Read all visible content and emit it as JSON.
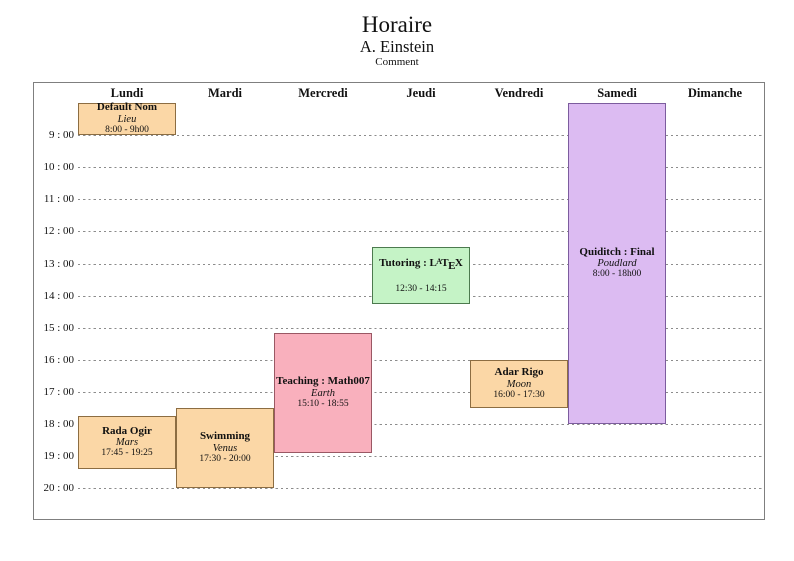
{
  "header": {
    "title": "Horaire",
    "subtitle": "A. Einstein",
    "comment": "Comment"
  },
  "colors": {
    "frame_border": "#7f7f7f",
    "grid_line": "#8c8c8c",
    "text": "#111111",
    "orange_fill": "#FBD7A6",
    "orange_border": "#8C6D42",
    "green_fill": "#C5F3C6",
    "green_border": "#4C7A4E",
    "pink_fill": "#F9B0BD",
    "pink_border": "#9A5864",
    "purple_fill": "#DCBBF2",
    "purple_border": "#7C5C9E"
  },
  "chart_data": {
    "type": "table",
    "title": "Horaire",
    "subtitle": "A. Einstein",
    "comment": "Comment",
    "days": [
      "Lundi",
      "Mardi",
      "Mercredi",
      "Jeudi",
      "Vendredi",
      "Samedi",
      "Dimanche"
    ],
    "hour_labels": [
      "9 : 00",
      "10 : 00",
      "11 : 00",
      "12 : 00",
      "13 : 00",
      "14 : 00",
      "15 : 00",
      "16 : 00",
      "17 : 00",
      "18 : 00",
      "19 : 00",
      "20 : 00"
    ],
    "time_axis": {
      "first_labeled_hour": 9,
      "last_labeled_hour": 20,
      "grid": "dashed-horizontal"
    },
    "events": [
      {
        "day": "Lundi",
        "title": "Default Nom",
        "location": "Lieu",
        "time_label": "8:00 - 9h00",
        "start": 8.0,
        "end": 9.0,
        "fill": "#FBD7A6",
        "border": "#8C6D42"
      },
      {
        "day": "Lundi",
        "title": "Rada Ogir",
        "location": "Mars",
        "time_label": "17:45 - 19:25",
        "start": 17.75,
        "end": 19.4167,
        "fill": "#FBD7A6",
        "border": "#8C6D42"
      },
      {
        "day": "Mardi",
        "title": "Swimming",
        "location": "Venus",
        "time_label": "17:30 - 20:00",
        "start": 17.5,
        "end": 20.0,
        "fill": "#FBD7A6",
        "border": "#8C6D42"
      },
      {
        "day": "Mercredi",
        "title": "Teaching : Math007",
        "location": "Earth",
        "time_label": "15:10 - 18:55",
        "start": 15.1667,
        "end": 18.9167,
        "fill": "#F9B0BD",
        "border": "#9A5864"
      },
      {
        "day": "Jeudi",
        "title": "Tutoring : LaTeX",
        "latex_logo": true,
        "location": "",
        "time_label": "12:30 - 14:15",
        "start": 12.5,
        "end": 14.25,
        "fill": "#C5F3C6",
        "border": "#4C7A4E"
      },
      {
        "day": "Vendredi",
        "title": "Adar Rigo",
        "location": "Moon",
        "time_label": "16:00 - 17:30",
        "start": 16.0,
        "end": 17.5,
        "fill": "#FBD7A6",
        "border": "#8C6D42"
      },
      {
        "day": "Samedi",
        "title": "Quiditch : Final",
        "location": "Poudlard",
        "time_label": "8:00 - 18h00",
        "start": 8.0,
        "end": 18.0,
        "fill": "#DCBBF2",
        "border": "#7C5C9E"
      }
    ]
  }
}
